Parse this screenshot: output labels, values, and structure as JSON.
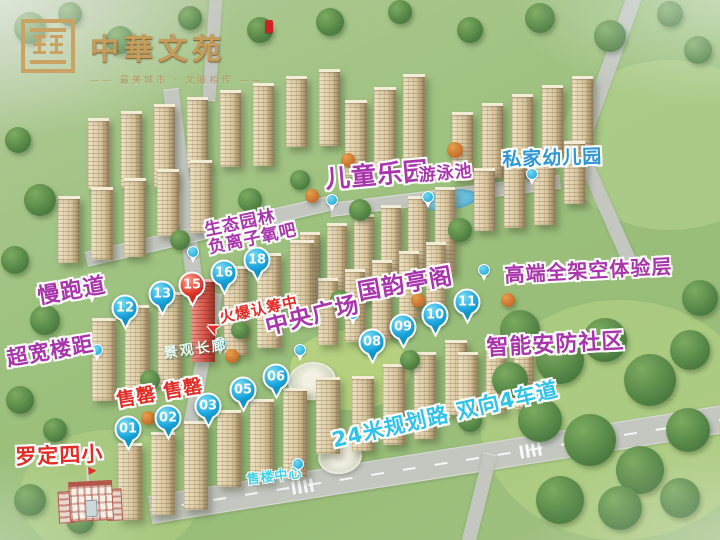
{
  "logo": {
    "title": "中華文苑",
    "tagline": "—— 最美城市 · 文脉相传 ——",
    "accent_color": "#cc2320",
    "gold_color": "#c49d5d"
  },
  "colors": {
    "label_magenta": "#a835ab",
    "label_blue": "#2d97d5",
    "label_red": "#e22d26",
    "label_cyan": "#2fc3ea",
    "pin_blue": "#18a2da",
    "pin_hot_red": "#e0392c"
  },
  "labels": [
    {
      "id": "jogging-track",
      "text": "慢跑道",
      "style": "magenta",
      "x": 36,
      "y": 286,
      "rot": -10,
      "size": 22
    },
    {
      "id": "wide-building-spacing",
      "text": "超宽楼距",
      "style": "magenta",
      "x": 5,
      "y": 348,
      "rot": -10,
      "size": 21
    },
    {
      "id": "children-playground",
      "text": "儿童乐园",
      "style": "magenta",
      "x": 324,
      "y": 166,
      "rot": -5,
      "size": 25
    },
    {
      "id": "swimming-pool",
      "text": "游泳池",
      "style": "magenta",
      "x": 418,
      "y": 167,
      "rot": -5,
      "size": 17
    },
    {
      "id": "private-kindergarten",
      "text": "私家幼儿园",
      "style": "blue",
      "x": 502,
      "y": 150,
      "rot": -2,
      "size": 19
    },
    {
      "id": "eco-garden-oxygen-bar",
      "text": "生态园林\n负离子氧吧",
      "style": "magenta",
      "x": 203,
      "y": 222,
      "rot": -12,
      "size": 17
    },
    {
      "id": "guoyun-pavilion",
      "text": "国韵亭阁",
      "style": "magenta",
      "x": 356,
      "y": 281,
      "rot": -10,
      "size": 23
    },
    {
      "id": "central-plaza",
      "text": "中央广场",
      "style": "magenta",
      "x": 263,
      "y": 316,
      "rot": -14,
      "size": 23
    },
    {
      "id": "elevated-experience-floor",
      "text": "高端全架空体验层",
      "style": "magenta",
      "x": 504,
      "y": 265,
      "rot": -3,
      "size": 20
    },
    {
      "id": "smart-security-community",
      "text": "智能安防社区",
      "style": "magenta",
      "x": 486,
      "y": 337,
      "rot": -3,
      "size": 22
    },
    {
      "id": "hot-registration",
      "text": "火爆认筹中",
      "style": "red",
      "x": 218,
      "y": 310,
      "rot": -12,
      "size": 15
    },
    {
      "id": "sold-out",
      "text": "售罄 售罄",
      "style": "red",
      "x": 115,
      "y": 391,
      "rot": -10,
      "size": 19
    },
    {
      "id": "luoding-no4-primary-school",
      "text": "罗定四小",
      "style": "red",
      "x": 15,
      "y": 446,
      "rot": -2,
      "size": 21
    },
    {
      "id": "landscape-corridor",
      "text": "景观长廊",
      "style": "soft",
      "x": 163,
      "y": 347,
      "rot": -8,
      "size": 14
    },
    {
      "id": "sales-center",
      "text": "售楼中心",
      "style": "cyan-sm",
      "x": 246,
      "y": 474,
      "rot": -7,
      "size": 13
    },
    {
      "id": "planned-road",
      "text": "24米规划路 双向4车道",
      "style": "cyan",
      "x": 330,
      "y": 430,
      "rot": -13,
      "size": 21
    }
  ],
  "pins": {
    "numbered": [
      {
        "num": "01",
        "x": 128,
        "y": 429
      },
      {
        "num": "02",
        "x": 168,
        "y": 418
      },
      {
        "num": "03",
        "x": 208,
        "y": 406
      },
      {
        "num": "05",
        "x": 243,
        "y": 390
      },
      {
        "num": "06",
        "x": 276,
        "y": 377
      },
      {
        "num": "08",
        "x": 372,
        "y": 342
      },
      {
        "num": "09",
        "x": 403,
        "y": 327
      },
      {
        "num": "10",
        "x": 435,
        "y": 315
      },
      {
        "num": "11",
        "x": 467,
        "y": 302
      },
      {
        "num": "12",
        "x": 125,
        "y": 308
      },
      {
        "num": "13",
        "x": 162,
        "y": 294
      },
      {
        "num": "15",
        "x": 192,
        "y": 285,
        "hot": true
      },
      {
        "num": "16",
        "x": 224,
        "y": 273
      },
      {
        "num": "18",
        "x": 257,
        "y": 260
      }
    ],
    "small": [
      {
        "x": 92,
        "y": 292
      },
      {
        "x": 97,
        "y": 350
      },
      {
        "x": 332,
        "y": 200
      },
      {
        "x": 428,
        "y": 197
      },
      {
        "x": 532,
        "y": 174
      },
      {
        "x": 193,
        "y": 252
      },
      {
        "x": 353,
        "y": 314
      },
      {
        "x": 484,
        "y": 270
      },
      {
        "x": 220,
        "y": 343
      },
      {
        "x": 300,
        "y": 350
      },
      {
        "x": 298,
        "y": 464
      }
    ]
  },
  "arrow": {
    "x": 206,
    "y": 318,
    "rot": 205,
    "glyph": "➤"
  }
}
